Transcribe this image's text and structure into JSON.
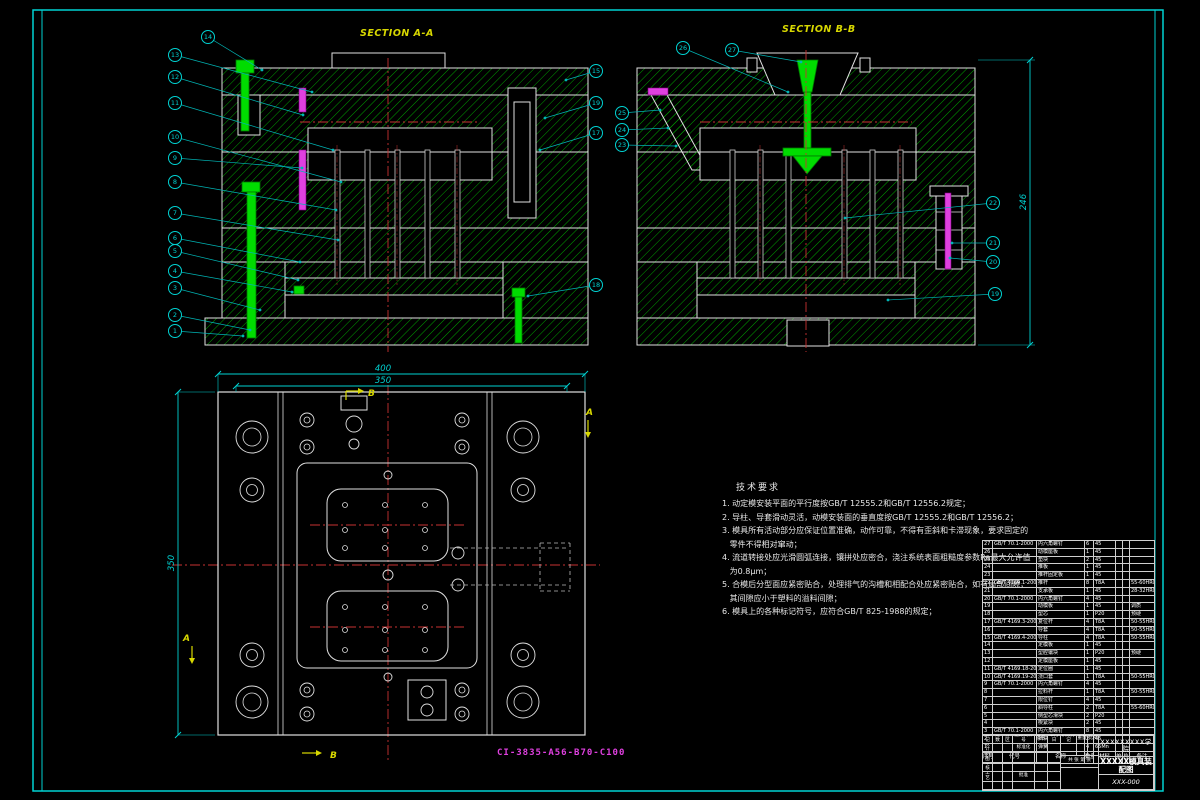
{
  "sheet": {
    "part_code": "CI-3835-A56-B70-C100",
    "border_color": "#00d2d2"
  },
  "views": {
    "section_a": {
      "label": "SECTION A-A",
      "x": 360,
      "y": 36
    },
    "section_b": {
      "label": "SECTION B-B",
      "x": 782,
      "y": 32
    },
    "plan_letters": [
      {
        "t": "B",
        "x": 368,
        "y": 396
      },
      {
        "t": "B",
        "x": 330,
        "y": 758
      },
      {
        "t": "A",
        "x": 586,
        "y": 415
      },
      {
        "t": "A",
        "x": 183,
        "y": 641
      }
    ]
  },
  "dimensions": [
    {
      "label": "400",
      "x1": 218,
      "y1": 374,
      "x2": 585,
      "y2": 374,
      "lx": 383,
      "ly": 371,
      "rot": 0
    },
    {
      "label": "350",
      "x1": 236,
      "y1": 386,
      "x2": 567,
      "y2": 386,
      "lx": 383,
      "ly": 383,
      "rot": 0
    },
    {
      "label": "350",
      "x1": 178,
      "y1": 392,
      "x2": 178,
      "y2": 735,
      "lx": 174,
      "ly": 563,
      "rot": -90
    },
    {
      "label": "246",
      "x1": 1030,
      "y1": 60,
      "x2": 1030,
      "y2": 345,
      "lx": 1026,
      "ly": 202,
      "rot": -90
    }
  ],
  "callouts": {
    "section_a": [
      {
        "n": "14",
        "x": 208,
        "y": 37,
        "tx": 262,
        "ty": 70
      },
      {
        "n": "13",
        "x": 175,
        "y": 55,
        "tx": 312,
        "ty": 92
      },
      {
        "n": "12",
        "x": 175,
        "y": 77,
        "tx": 303,
        "ty": 115
      },
      {
        "n": "11",
        "x": 175,
        "y": 103,
        "tx": 333,
        "ty": 150
      },
      {
        "n": "10",
        "x": 175,
        "y": 137,
        "tx": 341,
        "ty": 182
      },
      {
        "n": "9",
        "x": 175,
        "y": 158,
        "tx": 302,
        "ty": 168
      },
      {
        "n": "8",
        "x": 175,
        "y": 182,
        "tx": 336,
        "ty": 210
      },
      {
        "n": "7",
        "x": 175,
        "y": 213,
        "tx": 338,
        "ty": 240
      },
      {
        "n": "6",
        "x": 175,
        "y": 238,
        "tx": 300,
        "ty": 262
      },
      {
        "n": "5",
        "x": 175,
        "y": 251,
        "tx": 298,
        "ty": 280
      },
      {
        "n": "4",
        "x": 175,
        "y": 271,
        "tx": 292,
        "ty": 292
      },
      {
        "n": "3",
        "x": 175,
        "y": 288,
        "tx": 260,
        "ty": 310
      },
      {
        "n": "2",
        "x": 175,
        "y": 315,
        "tx": 250,
        "ty": 330
      },
      {
        "n": "1",
        "x": 175,
        "y": 331,
        "tx": 243,
        "ty": 336
      },
      {
        "n": "15",
        "x": 596,
        "y": 71,
        "tx": 566,
        "ty": 80
      },
      {
        "n": "19",
        "x": 596,
        "y": 103,
        "tx": 545,
        "ty": 118
      },
      {
        "n": "17",
        "x": 596,
        "y": 133,
        "tx": 540,
        "ty": 150
      },
      {
        "n": "18",
        "x": 596,
        "y": 285,
        "tx": 528,
        "ty": 296
      }
    ],
    "section_b": [
      {
        "n": "26",
        "x": 683,
        "y": 48,
        "tx": 788,
        "ty": 92
      },
      {
        "n": "27",
        "x": 732,
        "y": 50,
        "tx": 801,
        "ty": 62
      },
      {
        "n": "25",
        "x": 622,
        "y": 113,
        "tx": 660,
        "ty": 110
      },
      {
        "n": "24",
        "x": 622,
        "y": 130,
        "tx": 668,
        "ty": 128
      },
      {
        "n": "23",
        "x": 622,
        "y": 145,
        "tx": 676,
        "ty": 146
      },
      {
        "n": "22",
        "x": 993,
        "y": 203,
        "tx": 845,
        "ty": 218
      },
      {
        "n": "21",
        "x": 993,
        "y": 243,
        "tx": 952,
        "ty": 243
      },
      {
        "n": "20",
        "x": 993,
        "y": 262,
        "tx": 950,
        "ty": 258
      },
      {
        "n": "19",
        "x": 995,
        "y": 294,
        "tx": 888,
        "ty": 300
      }
    ]
  },
  "tech_requirements": {
    "title": "技术要求",
    "lines": [
      "1. 动定模安装平面的平行度按GB/T 12555.2和GB/T 12556.2规定；",
      "2. 导柱、导套滑动灵活，动模安装面的垂直度按GB/T 12555.2和GB/T 12556.2；",
      "3. 模具所有活动部分应保证位置准确，动作可靠，不得有歪斜和卡滞现象，要求固定的",
      "   零件不得相对窜动；",
      "4. 流道转接处应光滑圆弧连接，镶拼处应密合，浇注系统表面粗糙度参数Ra最大允许值",
      "   为0.8μm；",
      "5. 合模后分型面应紧密贴合，处理排气的沟槽和相配合处应紧密贴合，如有局部间隙，",
      "   其间隙应小于塑料的溢料间隙；",
      "6. 模具上的各种标记符号，应符合GB/T 825-1988的规定；"
    ]
  },
  "parts_list": {
    "headers": {
      "no": "序号",
      "code": "代号",
      "name": "名称",
      "qty": "数量",
      "mat": "材料",
      "w1": "单件",
      "w2": "总计",
      "note": "备注"
    },
    "rows": [
      {
        "no": "27",
        "code": "GB/T 70.1-2000",
        "name": "内六角螺钉",
        "qty": "6",
        "mat": "45",
        "note": ""
      },
      {
        "no": "26",
        "code": "",
        "name": "动模座板",
        "qty": "1",
        "mat": "45",
        "note": ""
      },
      {
        "no": "25",
        "code": "",
        "name": "垫块",
        "qty": "2",
        "mat": "45",
        "note": ""
      },
      {
        "no": "24",
        "code": "",
        "name": "推板",
        "qty": "1",
        "mat": "45",
        "note": ""
      },
      {
        "no": "23",
        "code": "",
        "name": "推杆固定板",
        "qty": "1",
        "mat": "45",
        "note": ""
      },
      {
        "no": "22",
        "code": "GB/T 4169.1-2006",
        "name": "推杆",
        "qty": "8",
        "mat": "T8A",
        "note": "55-60HRC"
      },
      {
        "no": "21",
        "code": "",
        "name": "支承板",
        "qty": "1",
        "mat": "45",
        "note": "28-32HRC"
      },
      {
        "no": "20",
        "code": "GB/T 70.1-2000",
        "name": "内六角螺钉",
        "qty": "4",
        "mat": "45",
        "note": ""
      },
      {
        "no": "19",
        "code": "",
        "name": "动模板",
        "qty": "1",
        "mat": "45",
        "note": "调质"
      },
      {
        "no": "18",
        "code": "",
        "name": "型芯",
        "qty": "1",
        "mat": "P20",
        "note": "预硬"
      },
      {
        "no": "17",
        "code": "GB/T 4169.3-2006",
        "name": "复位杆",
        "qty": "4",
        "mat": "T8A",
        "note": "50-55HRC"
      },
      {
        "no": "16",
        "code": "",
        "name": "导套",
        "qty": "4",
        "mat": "T8A",
        "note": "50-55HRC"
      },
      {
        "no": "15",
        "code": "GB/T 4169.4-2006",
        "name": "导柱",
        "qty": "4",
        "mat": "T8A",
        "note": "50-55HRC"
      },
      {
        "no": "14",
        "code": "",
        "name": "定模板",
        "qty": "1",
        "mat": "45",
        "note": ""
      },
      {
        "no": "13",
        "code": "",
        "name": "型腔镶块",
        "qty": "1",
        "mat": "P20",
        "note": "预硬"
      },
      {
        "no": "12",
        "code": "",
        "name": "定模座板",
        "qty": "1",
        "mat": "45",
        "note": ""
      },
      {
        "no": "11",
        "code": "GB/T 4169.18-2006",
        "name": "定位圈",
        "qty": "1",
        "mat": "45",
        "note": ""
      },
      {
        "no": "10",
        "code": "GB/T 4169.19-2006",
        "name": "浇口套",
        "qty": "1",
        "mat": "T8A",
        "note": "50-55HRC"
      },
      {
        "no": "9",
        "code": "GB/T 70.1-2000",
        "name": "内六角螺钉",
        "qty": "4",
        "mat": "45",
        "note": ""
      },
      {
        "no": "8",
        "code": "",
        "name": "拉料杆",
        "qty": "1",
        "mat": "T8A",
        "note": "50-55HRC"
      },
      {
        "no": "7",
        "code": "",
        "name": "限位钉",
        "qty": "4",
        "mat": "45",
        "note": ""
      },
      {
        "no": "6",
        "code": "",
        "name": "斜导柱",
        "qty": "2",
        "mat": "T8A",
        "note": "55-60HRC"
      },
      {
        "no": "5",
        "code": "",
        "name": "侧型芯滑块",
        "qty": "2",
        "mat": "P20",
        "note": ""
      },
      {
        "no": "4",
        "code": "",
        "name": "楔紧块",
        "qty": "2",
        "mat": "45",
        "note": ""
      },
      {
        "no": "3",
        "code": "GB/T 70.1-2000",
        "name": "内六角螺钉",
        "qty": "8",
        "mat": "45",
        "note": ""
      },
      {
        "no": "2",
        "code": "",
        "name": "挡块",
        "qty": "2",
        "mat": "45",
        "note": ""
      },
      {
        "no": "1",
        "code": "",
        "name": "弹簧",
        "qty": "4",
        "mat": "65Mn",
        "note": ""
      }
    ]
  },
  "title_block": {
    "school": "XXXXXXXXX学院",
    "title": "XXXXX模具装配图",
    "number": "XXX-000",
    "labels": {
      "mark": "标记",
      "count": "处数",
      "zone": "分区",
      "doc": "更改文件号",
      "sign": "签名",
      "date": "年月日",
      "design": "设计",
      "draw": "制图",
      "check": "审核",
      "process": "工艺",
      "std": "标准化",
      "approve": "批准",
      "stage": "阶段标记",
      "weight": "重量",
      "scale": "比例",
      "sheets": "共 张 第 张"
    }
  }
}
